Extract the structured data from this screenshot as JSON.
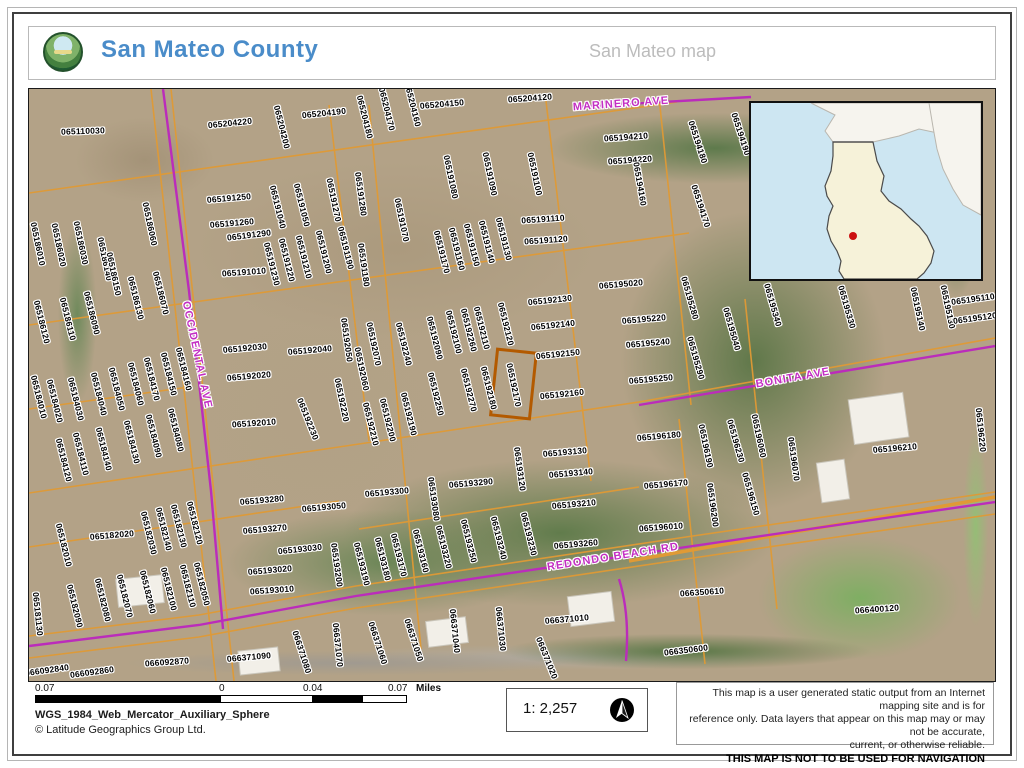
{
  "header": {
    "title": "San Mateo County",
    "subtitle": "San Mateo map"
  },
  "colors": {
    "title_blue": "#4A8CC9",
    "parcel_line": "#E09A35",
    "highlight_outline": "#B35A00",
    "street_magenta": "#C32EC3",
    "inset_water": "#CDE6F2",
    "inset_county_fill": "#F6F2D9",
    "inset_dot": "#CC1111"
  },
  "map": {
    "highlighted_parcel": "065192170",
    "streets": [
      [
        "MARINERO AVE",
        620,
        103,
        -4
      ],
      [
        "OCCIDENTAL AVE",
        196,
        354,
        78
      ],
      [
        "BONITA AVE",
        792,
        377,
        -10
      ],
      [
        "REDONDO BEACH RD",
        612,
        556,
        -9
      ]
    ],
    "parcels": [
      [
        "065110030",
        82,
        130,
        -2
      ],
      [
        "065204220",
        229,
        122,
        -6
      ],
      [
        "065204200",
        281,
        126,
        76
      ],
      [
        "065204190",
        323,
        112,
        -6
      ],
      [
        "065204180",
        364,
        116,
        76
      ],
      [
        "065204170",
        386,
        108,
        76
      ],
      [
        "065204160",
        412,
        104,
        76
      ],
      [
        "065204150",
        441,
        103,
        -5
      ],
      [
        "065204120",
        529,
        97,
        -4
      ],
      [
        "065194210",
        625,
        136,
        -4
      ],
      [
        "065194220",
        629,
        159,
        -4
      ],
      [
        "065194160",
        639,
        183,
        80
      ],
      [
        "065194180",
        697,
        141,
        72
      ],
      [
        "065194190",
        740,
        133,
        72
      ],
      [
        "065194170",
        700,
        205,
        72
      ],
      [
        "065191250",
        228,
        197,
        -5
      ],
      [
        "065191260",
        231,
        222,
        -5
      ],
      [
        "065191290",
        248,
        234,
        -7
      ],
      [
        "065191010",
        243,
        271,
        -4
      ],
      [
        "065191040",
        277,
        206,
        76
      ],
      [
        "065191050",
        301,
        204,
        76
      ],
      [
        "065191270",
        333,
        199,
        78
      ],
      [
        "065191230",
        271,
        263,
        76
      ],
      [
        "065191220",
        286,
        259,
        76
      ],
      [
        "065191210",
        303,
        256,
        76
      ],
      [
        "065191200",
        323,
        251,
        76
      ],
      [
        "065191190",
        345,
        247,
        76
      ],
      [
        "065191280",
        360,
        193,
        82
      ],
      [
        "065191180",
        363,
        264,
        82
      ],
      [
        "065191080",
        450,
        176,
        78
      ],
      [
        "065191090",
        489,
        173,
        78
      ],
      [
        "065191100",
        534,
        173,
        78
      ],
      [
        "065191070",
        401,
        219,
        78
      ],
      [
        "065191110",
        542,
        218,
        -4
      ],
      [
        "065191120",
        545,
        239,
        -4
      ],
      [
        "065191170",
        441,
        251,
        76
      ],
      [
        "065191160",
        456,
        248,
        76
      ],
      [
        "065191150",
        471,
        244,
        76
      ],
      [
        "065191140",
        486,
        241,
        76
      ],
      [
        "065191130",
        503,
        238,
        76
      ],
      [
        "065186010",
        37,
        243,
        78
      ],
      [
        "065186020",
        58,
        244,
        78
      ],
      [
        "065186030",
        80,
        242,
        78
      ],
      [
        "065186140",
        104,
        258,
        78
      ],
      [
        "065186150",
        113,
        273,
        78
      ],
      [
        "065186060",
        149,
        223,
        78
      ],
      [
        "065186120",
        41,
        321,
        76
      ],
      [
        "065186110",
        67,
        318,
        76
      ],
      [
        "065186090",
        91,
        312,
        76
      ],
      [
        "065186130",
        135,
        297,
        76
      ],
      [
        "065186070",
        160,
        292,
        76
      ],
      [
        "065184010",
        38,
        396,
        76
      ],
      [
        "065184020",
        54,
        400,
        76
      ],
      [
        "065184030",
        75,
        398,
        76
      ],
      [
        "065184040",
        98,
        393,
        76
      ],
      [
        "065184050",
        116,
        388,
        76
      ],
      [
        "065184060",
        135,
        383,
        76
      ],
      [
        "065184170",
        151,
        378,
        76
      ],
      [
        "065184150",
        168,
        373,
        76
      ],
      [
        "065184160",
        183,
        368,
        76
      ],
      [
        "065184120",
        63,
        459,
        76
      ],
      [
        "065184110",
        80,
        453,
        76
      ],
      [
        "065184140",
        103,
        448,
        76
      ],
      [
        "065184130",
        131,
        441,
        76
      ],
      [
        "065184090",
        153,
        435,
        76
      ],
      [
        "065184080",
        175,
        429,
        76
      ],
      [
        "065192030",
        244,
        347,
        -5
      ],
      [
        "065192040",
        309,
        349,
        -5
      ],
      [
        "065192020",
        248,
        375,
        -5
      ],
      [
        "065192010",
        253,
        422,
        -4
      ],
      [
        "065192050",
        346,
        339,
        82
      ],
      [
        "065192220",
        341,
        399,
        78
      ],
      [
        "065192230",
        307,
        418,
        68
      ],
      [
        "065192060",
        361,
        368,
        78
      ],
      [
        "065192070",
        373,
        343,
        78
      ],
      [
        "065192240",
        403,
        343,
        76
      ],
      [
        "065192090",
        434,
        337,
        76
      ],
      [
        "065192100",
        453,
        331,
        76
      ],
      [
        "065192260",
        468,
        329,
        76
      ],
      [
        "065192110",
        481,
        327,
        76
      ],
      [
        "065192120",
        505,
        323,
        76
      ],
      [
        "065192210",
        370,
        423,
        76
      ],
      [
        "065192200",
        387,
        419,
        76
      ],
      [
        "065192190",
        408,
        413,
        76
      ],
      [
        "065192250",
        435,
        393,
        76
      ],
      [
        "065192270",
        468,
        389,
        76
      ],
      [
        "065192180",
        488,
        387,
        76
      ],
      [
        "065192130",
        549,
        299,
        -6
      ],
      [
        "065192140",
        552,
        324,
        -6
      ],
      [
        "065192150",
        557,
        353,
        -6
      ],
      [
        "065192160",
        561,
        393,
        -6
      ],
      [
        "065192170",
        513,
        384,
        78
      ],
      [
        "065195020",
        620,
        283,
        -5
      ],
      [
        "065195220",
        643,
        318,
        -5
      ],
      [
        "065195240",
        647,
        342,
        -5
      ],
      [
        "065195250",
        650,
        378,
        -5
      ],
      [
        "065195280",
        689,
        297,
        74
      ],
      [
        "065195290",
        695,
        357,
        74
      ],
      [
        "065195040",
        731,
        328,
        74
      ],
      [
        "065195340",
        772,
        304,
        74
      ],
      [
        "065195330",
        846,
        306,
        74
      ],
      [
        "065195140",
        917,
        308,
        78
      ],
      [
        "065195130",
        947,
        306,
        78
      ],
      [
        "065195110",
        972,
        298,
        -8
      ],
      [
        "065195120",
        974,
        317,
        -8
      ],
      [
        "065196180",
        658,
        435,
        -5
      ],
      [
        "065196170",
        665,
        483,
        -5
      ],
      [
        "065196010",
        660,
        526,
        -4
      ],
      [
        "065196190",
        705,
        445,
        78
      ],
      [
        "065196230",
        735,
        440,
        74
      ],
      [
        "065196060",
        758,
        435,
        78
      ],
      [
        "065196200",
        712,
        504,
        82
      ],
      [
        "065196150",
        750,
        493,
        74
      ],
      [
        "065196070",
        793,
        458,
        82
      ],
      [
        "065196210",
        894,
        447,
        -5
      ],
      [
        "065196220",
        980,
        429,
        84
      ],
      [
        "065193280",
        261,
        499,
        -5
      ],
      [
        "065193050",
        323,
        506,
        -5
      ],
      [
        "065193270",
        264,
        528,
        -5
      ],
      [
        "065193030",
        299,
        548,
        -6
      ],
      [
        "065193020",
        269,
        569,
        -5
      ],
      [
        "065193010",
        271,
        589,
        -4
      ],
      [
        "065193200",
        336,
        564,
        82
      ],
      [
        "065193300",
        386,
        491,
        -5
      ],
      [
        "065193080",
        433,
        498,
        82
      ],
      [
        "065193290",
        470,
        482,
        -5
      ],
      [
        "065193120",
        519,
        468,
        82
      ],
      [
        "065193130",
        564,
        451,
        -5
      ],
      [
        "065193140",
        570,
        472,
        -5
      ],
      [
        "065193210",
        573,
        503,
        -5
      ],
      [
        "065193260",
        575,
        543,
        -5
      ],
      [
        "065193190",
        361,
        563,
        76
      ],
      [
        "065193180",
        382,
        558,
        76
      ],
      [
        "065193170",
        398,
        554,
        76
      ],
      [
        "065193160",
        420,
        550,
        76
      ],
      [
        "065193220",
        443,
        546,
        76
      ],
      [
        "065193250",
        468,
        540,
        76
      ],
      [
        "065193240",
        498,
        537,
        76
      ],
      [
        "065193230",
        528,
        533,
        76
      ],
      [
        "065181130",
        37,
        613,
        84
      ],
      [
        "065182010",
        63,
        544,
        76
      ],
      [
        "065182020",
        111,
        534,
        -5
      ],
      [
        "065182030",
        148,
        532,
        76
      ],
      [
        "065182140",
        163,
        528,
        76
      ],
      [
        "065182130",
        178,
        525,
        76
      ],
      [
        "065182120",
        194,
        522,
        76
      ],
      [
        "065182090",
        74,
        605,
        76
      ],
      [
        "065182080",
        102,
        599,
        76
      ],
      [
        "065182070",
        124,
        595,
        76
      ],
      [
        "065182060",
        147,
        591,
        76
      ],
      [
        "065182100",
        168,
        588,
        76
      ],
      [
        "065182110",
        187,
        585,
        76
      ],
      [
        "065182050",
        201,
        583,
        76
      ],
      [
        "066092840",
        46,
        669,
        -8
      ],
      [
        "066092860",
        91,
        671,
        -8
      ],
      [
        "066092870",
        166,
        661,
        -4
      ],
      [
        "066371090",
        248,
        656,
        -5
      ],
      [
        "066371080",
        301,
        651,
        72
      ],
      [
        "066371070",
        337,
        644,
        84
      ],
      [
        "066371060",
        377,
        642,
        72
      ],
      [
        "066371050",
        413,
        639,
        72
      ],
      [
        "066371040",
        454,
        630,
        84
      ],
      [
        "066371030",
        500,
        628,
        84
      ],
      [
        "066371010",
        566,
        618,
        -5
      ],
      [
        "066371020",
        546,
        657,
        68
      ],
      [
        "066350610",
        701,
        591,
        -4
      ],
      [
        "066350600",
        685,
        649,
        -7
      ],
      [
        "066400120",
        876,
        608,
        -4
      ]
    ]
  },
  "footer": {
    "scale_bar": {
      "labels": [
        "0.07",
        "0",
        "0.04",
        "0.07"
      ],
      "unit": "Miles"
    },
    "projection": "WGS_1984_Web_Mercator_Auxiliary_Sphere",
    "copyright": "© Latitude Geographics Group Ltd.",
    "scale_ratio": "1: 2,257",
    "disclaimer_lines": [
      "This map is a user generated static output from an Internet mapping site and is for",
      "reference only. Data layers that appear on this map may or may not be accurate,",
      "current, or otherwise reliable."
    ],
    "navigation_warning": "THIS MAP IS NOT TO BE USED FOR NAVIGATION"
  }
}
